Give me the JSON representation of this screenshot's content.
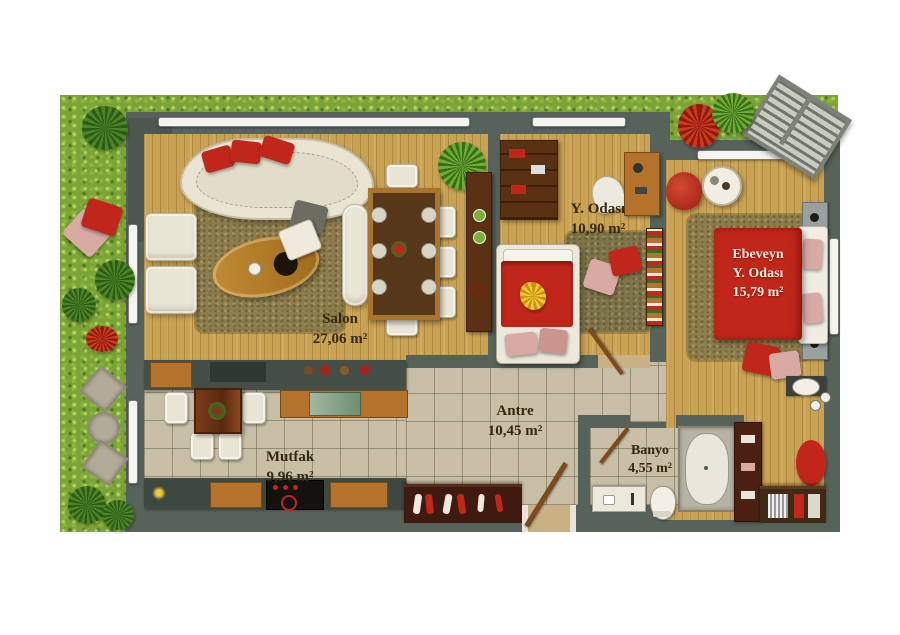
{
  "plan_title": "apartment-floor-plan",
  "rooms": {
    "salon": {
      "name": "Salon",
      "area": "27,06 m²"
    },
    "child": {
      "name": "Y. Odası",
      "area": "10,90 m²"
    },
    "parent": {
      "name_line1": "Ebeveyn",
      "name_line2": "Y. Odası",
      "area": "15,79 m²"
    },
    "antre": {
      "name": "Antre",
      "area": "10,45 m²"
    },
    "kitchen": {
      "name": "Mutfak",
      "area": "9,96 m²"
    },
    "bath": {
      "name": "Banyo",
      "area": "4,55 m²"
    }
  },
  "colors": {
    "grass": "#7aa437",
    "wall": "#57625a",
    "wood_floor": "#c9a254",
    "tile_floor": "#c8bfa6",
    "rug_brown": "#8d7d4d",
    "accent_red": "#c0271a",
    "accent_pink": "#d9aaa4",
    "furniture_white": "#eae6d6",
    "wood_furniture": "#b5722a",
    "dark_wood": "#5a3113",
    "label_text": "#33290f",
    "bed_label_text": "#f7ece0"
  }
}
